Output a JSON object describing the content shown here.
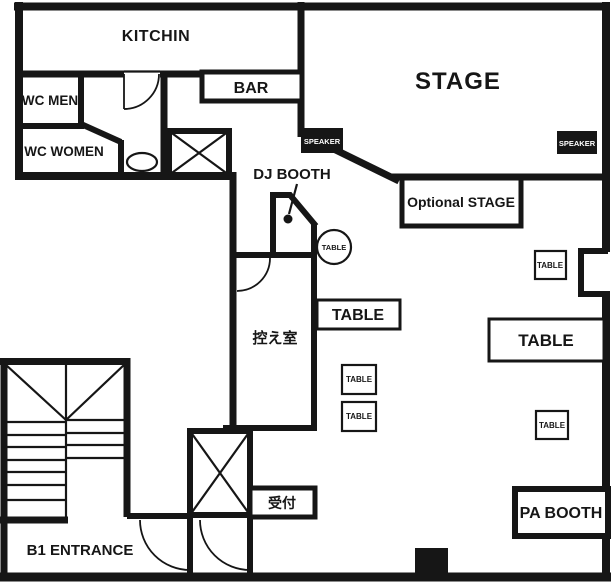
{
  "plan_title": "B1 venue floor plan",
  "colors": {
    "wall": "#161616",
    "background": "#ffffff",
    "speaker_bg": "#161616",
    "speaker_text": "#ffffff",
    "pillar": "#161616"
  },
  "rooms": {
    "kitchen": {
      "label": "KITCHIN"
    },
    "wc_men": {
      "label": "WC MEN"
    },
    "wc_women": {
      "label": "WC WOMEN"
    },
    "bar": {
      "label": "BAR"
    },
    "stage": {
      "label": "STAGE"
    },
    "optional_stage": {
      "label": "Optional STAGE"
    },
    "dj_booth": {
      "label": "DJ BOOTH"
    },
    "dressing_room": {
      "label": "控え室"
    },
    "reception": {
      "label": "受付"
    },
    "b1_entrance": {
      "label": "B1 ENTRANCE"
    },
    "pa_booth": {
      "label": "PA BOOTH"
    }
  },
  "speakers": {
    "left_label": "SPEAKER",
    "right_label": "SPEAKER"
  },
  "tables": {
    "round_label": "TABLE",
    "rect_left_label": "TABLE",
    "rect_right_label": "TABLE",
    "small_1_label": "TABLE",
    "small_2_label": "TABLE",
    "small_3_label": "TABLE",
    "small_4_label": "TABLE"
  }
}
